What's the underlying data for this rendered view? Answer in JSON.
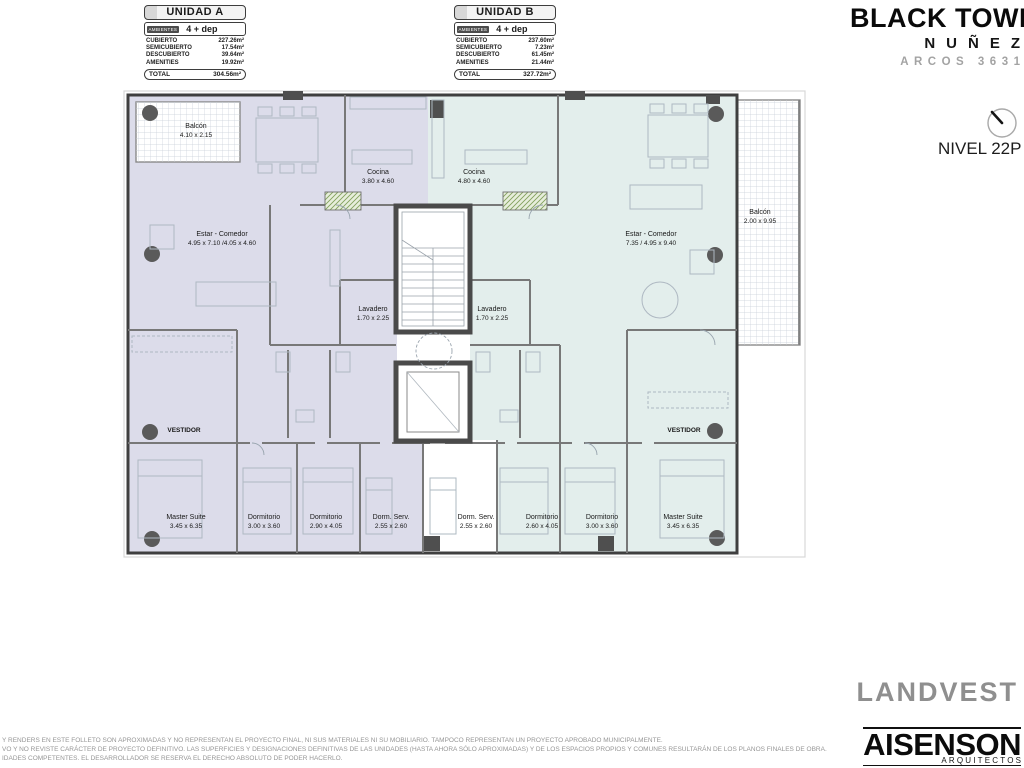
{
  "header": {
    "title": "BLACK TOWER",
    "subtitle": "NUÑEZ",
    "address": "ARCOS 3631",
    "level_label": "NIVEL 22P"
  },
  "unit_tables": [
    {
      "name": "UNIDAD A",
      "ambientes_label": "AMBIENTES",
      "ambientes_value": "4 + dep",
      "rows": [
        {
          "label": "CUBIERTO",
          "value": "227.26m²"
        },
        {
          "label": "SEMICUBIERTO",
          "value": "17.54m²"
        },
        {
          "label": "DESCUBIERTO",
          "value": "39.64m²"
        },
        {
          "label": "AMENITIES",
          "value": "19.92m²"
        }
      ],
      "total_label": "TOTAL",
      "total_value": "304.56m²"
    },
    {
      "name": "UNIDAD B",
      "ambientes_label": "AMBIENTES",
      "ambientes_value": "4 + dep",
      "rows": [
        {
          "label": "CUBIERTO",
          "value": "237.60m²"
        },
        {
          "label": "SEMICUBIERTO",
          "value": "7.23m²"
        },
        {
          "label": "DESCUBIERTO",
          "value": "61.45m²"
        },
        {
          "label": "AMENITIES",
          "value": "21.44m²"
        }
      ],
      "total_label": "TOTAL",
      "total_value": "327.72m²"
    }
  ],
  "plan": {
    "unit_a_color": "#dcdcea",
    "unit_b_color": "#e3eeec",
    "wall_color": "#4a4a4a",
    "rooms_a": {
      "balcon": {
        "name": "Balcón",
        "dims": "4.10 x 2.15"
      },
      "estar": {
        "name": "Estar - Comedor",
        "dims": "4.95 x 7.10 /4.05 x 4.60"
      },
      "cocina": {
        "name": "Cocina",
        "dims": "3.80 x 4.60"
      },
      "lavadero": {
        "name": "Lavadero",
        "dims": "1.70 x 2.25"
      },
      "vestidor": {
        "name": "VESTIDOR"
      },
      "master": {
        "name": "Master Suite",
        "dims": "3.45 x 6.35"
      },
      "dorm1": {
        "name": "Dormitorio",
        "dims": "3.00 x 3.60"
      },
      "dorm2": {
        "name": "Dormitorio",
        "dims": "2.90 x 4.05"
      },
      "dormserv": {
        "name": "Dorm. Serv.",
        "dims": "2.55 x 2.60"
      }
    },
    "rooms_b": {
      "cocina": {
        "name": "Cocina",
        "dims": "4.80 x 4.60"
      },
      "lavadero": {
        "name": "Lavadero",
        "dims": "1.70 x 2.25"
      },
      "estar": {
        "name": "Estar - Comedor",
        "dims": "7.35 / 4.95 x 9.40"
      },
      "balcon": {
        "name": "Balcón",
        "dims": "2.00 x 9.95"
      },
      "dormserv": {
        "name": "Dorm. Serv.",
        "dims": "2.55 x 2.60"
      },
      "dorm1": {
        "name": "Dormitorio",
        "dims": "2.60 x 4.05"
      },
      "dorm2": {
        "name": "Dormitorio",
        "dims": "3.00 x 3.60"
      },
      "vestidor": {
        "name": "VESTIDOR"
      },
      "master": {
        "name": "Master Suite",
        "dims": "3.45 x 6.35"
      }
    }
  },
  "footer": {
    "disclaimer_lines": [
      "Y RENDERS EN ESTE FOLLETO SON APROXIMADAS Y NO REPRESENTAN EL PROYECTO FINAL, NI SUS MATERIALES NI SU MOBILIARIO. TAMPOCO REPRESENTAN UN PROYECTO APROBADO MUNICIPALMENTE.",
      "VO Y NO REVISTE CARÁCTER DE PROYECTO DEFINITIVO. LAS SUPERFICIES Y DESIGNACIONES DEFINITIVAS DE LAS UNIDADES (HASTA AHORA SÓLO APROXIMADAS) Y DE LOS ESPACIOS PROPIOS Y COMUNES RESULTARÁN DE LOS PLANOS FINALES DE OBRA.",
      "IDADES COMPETENTES. EL DESARROLLADOR SE RESERVA EL DERECHO ABSOLUTO DE PODER HACERLO."
    ],
    "brand_landvest": "LANDVEST",
    "brand_aisenson": "AISENSON",
    "brand_aisenson_sub": "ARQUITECTOS"
  }
}
